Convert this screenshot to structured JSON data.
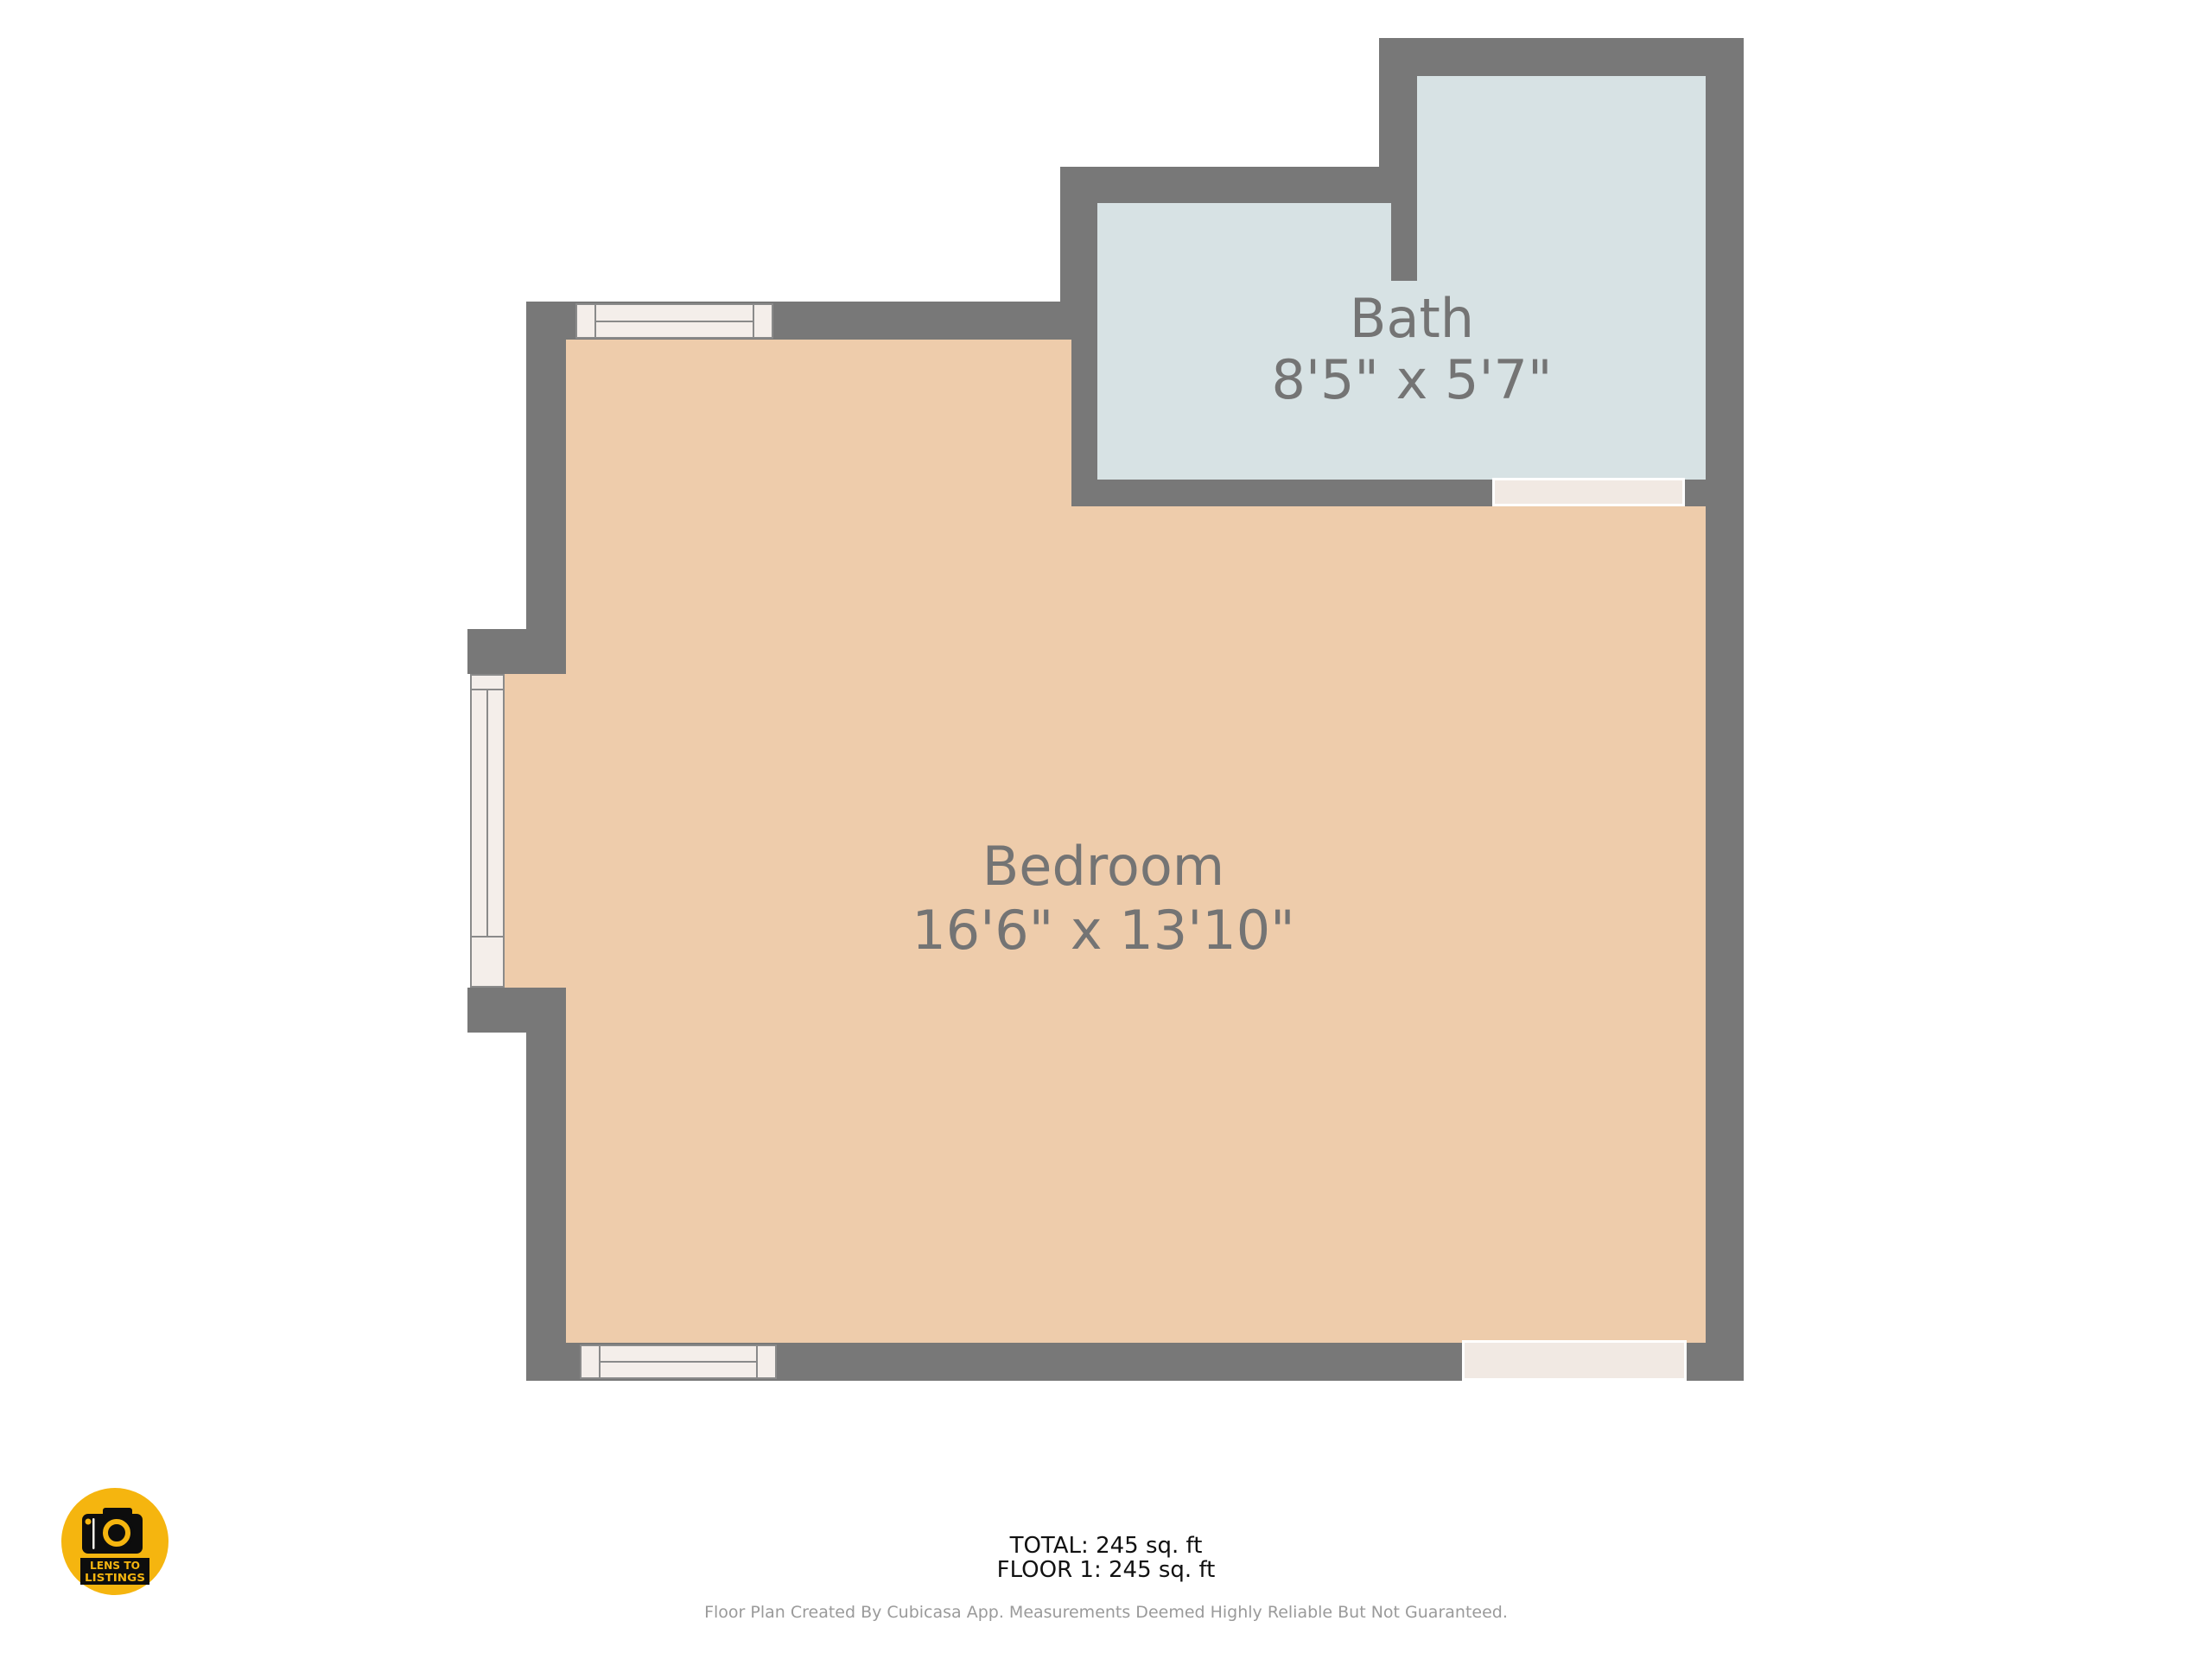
{
  "floor_plan": {
    "rooms": [
      {
        "name": "Bath",
        "dimensions": "8'5\" x 5'7\""
      },
      {
        "name": "Bedroom",
        "dimensions": "16'6\" x 13'10\""
      }
    ],
    "summary": {
      "total_label": "TOTAL: 245 sq. ft",
      "floor1_label": "FLOOR 1: 245 sq. ft"
    },
    "disclaimer": "Floor Plan Created By Cubicasa App. Measurements Deemed Highly Reliable But Not Guaranteed."
  },
  "logo": {
    "line1": "LENS TO",
    "line2": "LISTINGS"
  },
  "colors": {
    "wall": "#787878",
    "bedroom_floor": "#eeccab",
    "bath_floor": "#d7e2e4",
    "window_fill": "#f4eeea",
    "window_frame": "#8a8a8a",
    "door_fill": "#f1e9e3",
    "door_border": "#ffffff",
    "room_label": "#747474",
    "summary_text": "#111111",
    "disclaimer_text": "#9a9a9a",
    "logo_yellow": "#f5b50f",
    "logo_black": "#0d0d0d",
    "background": "#ffffff"
  }
}
